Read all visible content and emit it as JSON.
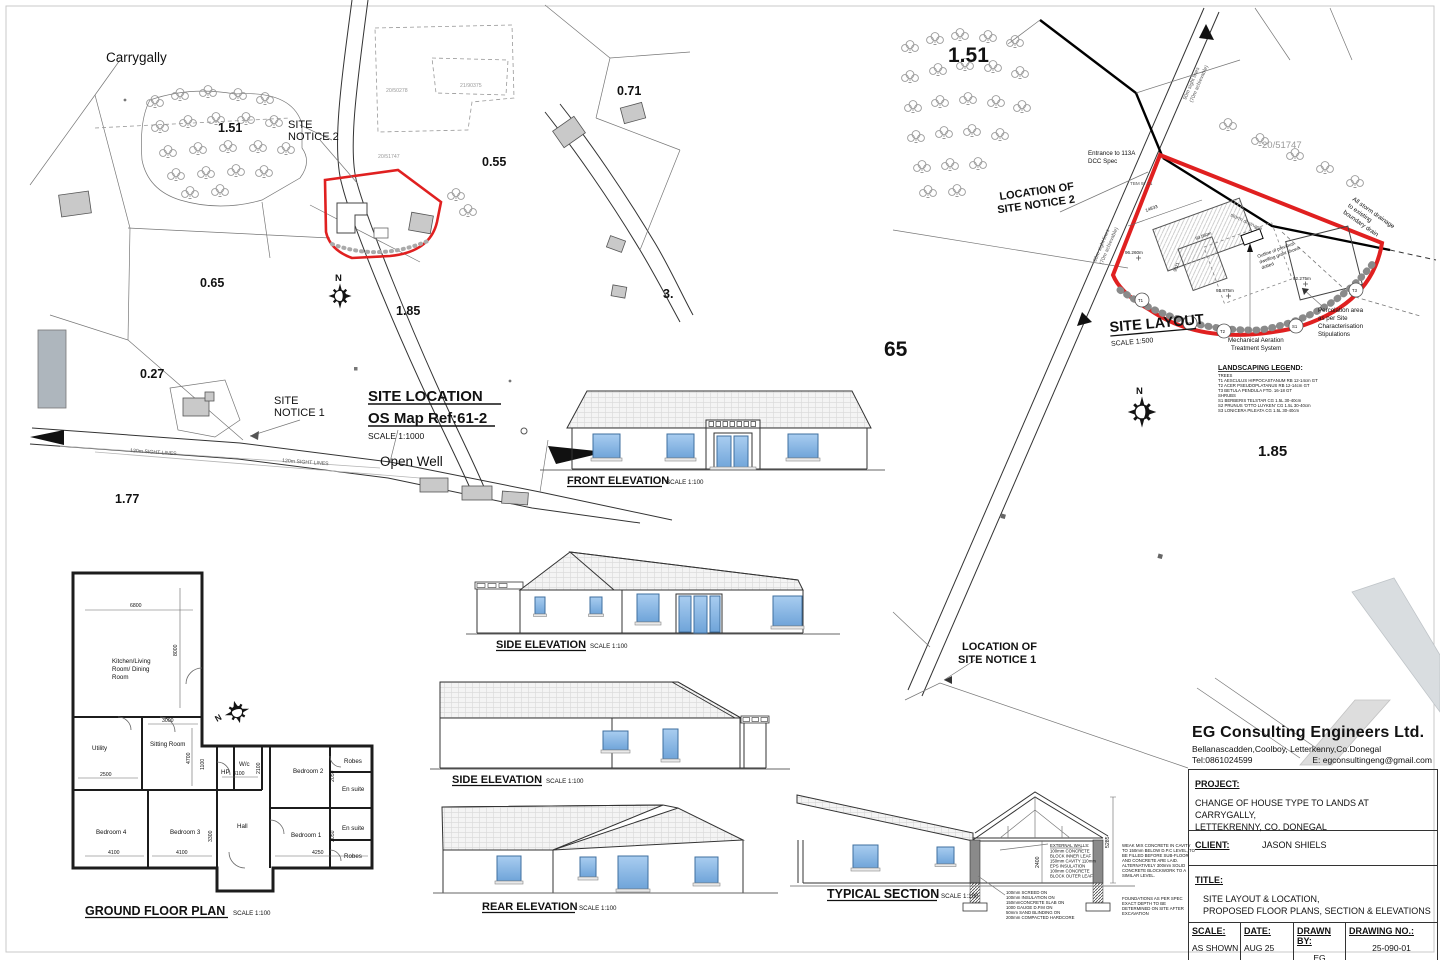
{
  "common": {
    "north": "N"
  },
  "colors": {
    "boundary_red": "#e02020",
    "window_blue": "#8ab9e6",
    "building_gray": "#c9c9c9"
  },
  "loc": {
    "townland": "Carrygally",
    "a151": "1.51",
    "a065": "0.65",
    "a071": "0.71",
    "a055": "0.55",
    "a185": "1.85",
    "a027": "0.27",
    "a177": "1.77",
    "a3": "3.",
    "notice2_1": "SITE",
    "notice2_2": "NOTICE 2",
    "notice1_1": "SITE",
    "notice1_2": "NOTICE 1",
    "title": "SITE LOCATION",
    "ref": "OS Map Ref:61-2",
    "scale": "SCALE 1:1000",
    "open_well": "Open Well",
    "sight": "120m SIGHT LINES",
    "p1": "20/50278",
    "p2": "21/90375",
    "p3": "20/51747"
  },
  "layout": {
    "a151": "1.51",
    "a185": "1.85",
    "a65": "65",
    "parcel": "20/51747",
    "title": "SITE LAYOUT",
    "scale": "SCALE 1:500",
    "notice2_1": "LOCATION OF",
    "notice2_2": "SITE NOTICE 2",
    "notice1_1": "LOCATION OF",
    "notice1_2": "SITE NOTICE 1",
    "entrance_1": "Entrance to 113A",
    "entrance_2": "DCC Spec",
    "tbm": "TBM 97.21",
    "road_1": "90m sight lines",
    "road_2": "(70m achievable)",
    "storm_small": "storm drainage",
    "storm_1": "All storm drainage",
    "storm_2": "to existing",
    "storm_3": "boundary drain",
    "dwelling_1": "Outline of previous",
    "dwelling_2": "dwelling grant shown",
    "dwelling_3": "dotted",
    "mats_1": "Mechanical Aeration",
    "mats_2": "Treatment System",
    "perc_1": "Percolation area",
    "perc_2": "as per Site",
    "perc_3": "Characterisation",
    "perc_4": "Stipulations",
    "lv1": "96.260m",
    "lv2": "93.875m",
    "lv3": "92.275m",
    "lv4": "93.560m",
    "dim1": "14833",
    "dim2": "9321",
    "legend_title": "LANDSCAPING LEGEND:",
    "legend": [
      "TREES",
      "T1 AESCULUS HIPPOCASTANUM RB 12-14cm GT",
      "T2 ACER PSEUDOPLATANUS RB 12-14cm GT",
      "T3 BETULA PENDULA FTD. 16-18 GT",
      "SHRUBS",
      "S1 BERBERIS TELSTAR CG 1.5L 30-40cm",
      "S2 PRUNUS 'OTTO LUYKEN' CG 1.5L 30-40cm",
      "S3 LONICERA PILEATA CG 1.5L 30-40cm"
    ],
    "tags": {
      "t1": "T1",
      "t2": "T2",
      "t3": "T3",
      "s1": "S1",
      "s2": "S2"
    }
  },
  "elev": {
    "front_label": "FRONT ELEVATION",
    "side_label": "SIDE ELEVATION",
    "rear_label": "REAR ELEVATION",
    "scale_100": "SCALE 1:100"
  },
  "section": {
    "label": "TYPICAL SECTION",
    "scale": "SCALE 1:100",
    "dim_h": "5285",
    "dim_r": "2400",
    "wall_note": [
      "EXTERNAL WALLS:",
      "100mm CONCRETE",
      "BLOCK INNER LEAF",
      "150mm CAVITY 110mm",
      "EPS INSULATION",
      "100mm CONCRETE",
      "BLOCK OUTER LEAF"
    ],
    "floor_note": [
      "100mm SCREED ON",
      "100mm INSULATION ON",
      "150mmCONCRETE SLAB ON",
      "1000 GAUGE D.P.M ON",
      "50mm SAND BLINDING ON",
      "200mm COMPACTED HARDCORE"
    ],
    "cavity_note": [
      "WEAK MIX CONCRETE IN CAVITY",
      "TO 150mm BELOW D.P.C LEVEL, TO",
      "BE FILLED BEFORE SUB-FLOOR",
      "AND CONCRETE ARE LAID.",
      "ALTERNATIVELY 300mm SOLID",
      "CONCRETE BLOCKWORK TO A",
      "SIMILAR LEVEL."
    ],
    "found_note": [
      "FOUNDATIONS AS PER SPEC",
      "EXACT DEPTH TO BE",
      "DETERMINED ON SITE AFTER",
      "EXCAVATION"
    ]
  },
  "plan": {
    "label": "GROUND FLOOR PLAN",
    "scale": "SCALE 1:100",
    "rooms": {
      "kitchen1": "Kitchen/Living",
      "kitchen2": "Room/ Dining",
      "kitchen3": "Room",
      "utility": "Utility",
      "sitting": "Sitting Room",
      "hp": "HP",
      "wc": "W/c",
      "bed1": "Bedroom 1",
      "bed2": "Bedroom 2",
      "bed3": "Bedroom 3",
      "bed4": "Bedroom 4",
      "hall": "Hall",
      "robes": "Robes",
      "ensuite": "En suite"
    },
    "dims": {
      "d6800": "6800",
      "d8000": "8000",
      "d3000": "3000",
      "d4700": "4700",
      "d2500": "2500",
      "d1100": "1100",
      "d3100": "3100",
      "d2100": "2100",
      "d4100": "4100",
      "d4250": "4250",
      "d3300": "3300",
      "d2050": "2050"
    }
  },
  "title_block": {
    "company": "EG Consulting Engineers Ltd.",
    "address": "Bellanascadden,Coolboy, Letterkenny,Co.Donegal",
    "tel": "Tel:0861024599",
    "email": "E: egconsultingeng@gmail.com",
    "project_label": "PROJECT:",
    "project_1": "CHANGE OF HOUSE TYPE TO LANDS AT CARRYGALLY,",
    "project_2": "LETTEKRENNY, CO. DONEGAL",
    "client_label": "CLIENT:",
    "client": "JASON SHIELS",
    "title_label": "TITLE:",
    "title_1": "SITE LAYOUT & LOCATION,",
    "title_2": "PROPOSED FLOOR PLANS, SECTION & ELEVATIONS",
    "scale_label": "SCALE:",
    "scale_value": "AS SHOWN",
    "date_label": "DATE:",
    "date_value": "AUG 25",
    "drawn_label": "DRAWN BY:",
    "drawn_value": "EG",
    "number_label": "DRAWING NO.:",
    "number_value": "25-090-01"
  }
}
